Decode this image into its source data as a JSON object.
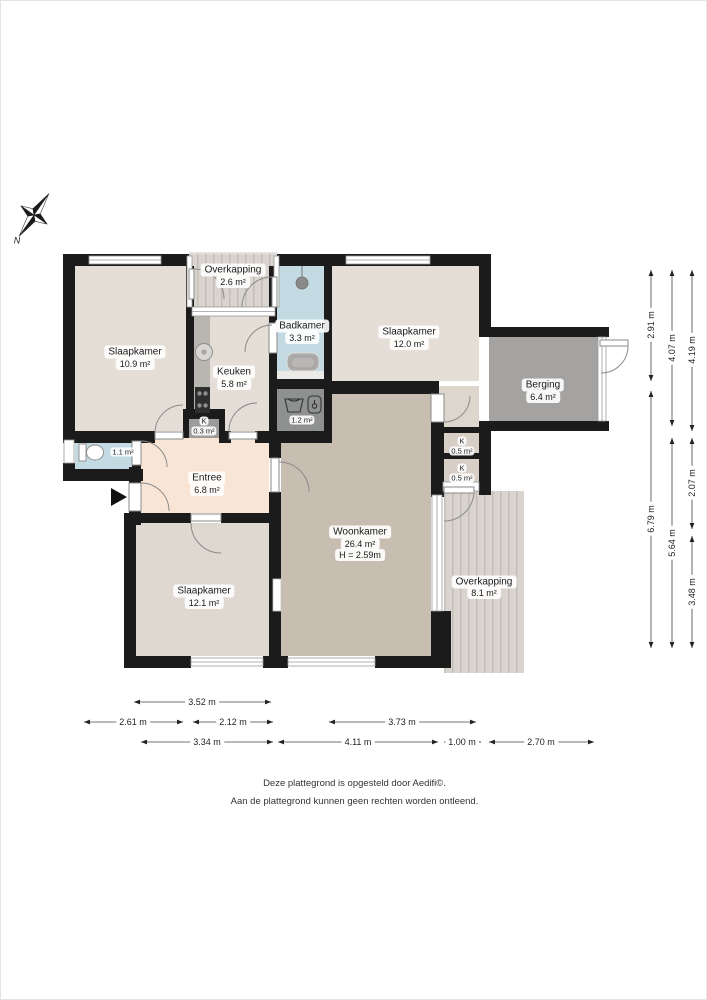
{
  "plan": {
    "compass_label": "N",
    "rooms": [
      {
        "name": "Slaapkamer",
        "area": "10.9 m²"
      },
      {
        "name": "Overkapping",
        "area": "2.6 m²"
      },
      {
        "name": "Badkamer",
        "area": "3.3 m²"
      },
      {
        "name": "Slaapkamer",
        "area": "12.0 m²"
      },
      {
        "name": "Keuken",
        "area": "5.8 m²"
      },
      {
        "name": "Berging",
        "area": "6.4 m²"
      },
      {
        "name": "K",
        "area": "0.3 m²"
      },
      {
        "name": "",
        "area": "1.2 m²"
      },
      {
        "name": "",
        "area": "1.1 m²"
      },
      {
        "name": "Entree",
        "area": "6.8 m²"
      },
      {
        "name": "K",
        "area": "0.5 m²"
      },
      {
        "name": "K",
        "area": "0.5 m²"
      },
      {
        "name": "Woonkamer",
        "area": "26.4 m²",
        "height": "H = 2.59m"
      },
      {
        "name": "Slaapkamer",
        "area": "12.1 m²"
      },
      {
        "name": "Overkapping",
        "area": "8.1 m²"
      }
    ],
    "dimensions": {
      "bottom": [
        "3.52 m",
        "2.61 m",
        "2.12 m",
        "3.73 m",
        "3.34 m",
        "4.11 m",
        "1.00 m",
        "2.70 m"
      ],
      "right": [
        "2.91 m",
        "6.79 m",
        "4.07 m",
        "5.64 m",
        "4.19 m",
        "2.07 m",
        "3.48 m"
      ]
    },
    "colors": {
      "wall": "#1b1b1b",
      "bedroom": "#e4ded6",
      "living_room": "#c8bdb1",
      "entry": "#f8e5d5",
      "bathroom": "#c3dae3",
      "storage": "#a5a3a1",
      "utility": "#8f9191",
      "closet_beige": "#d7cec5",
      "closet_gray": "#9c9c9a",
      "deck": "#d9d5ce"
    }
  },
  "footer": {
    "line1": "Deze plattegrond is opgesteld door Aedifi©.",
    "line2": "Aan de plattegrond kunnen geen rechten worden ontleend."
  }
}
